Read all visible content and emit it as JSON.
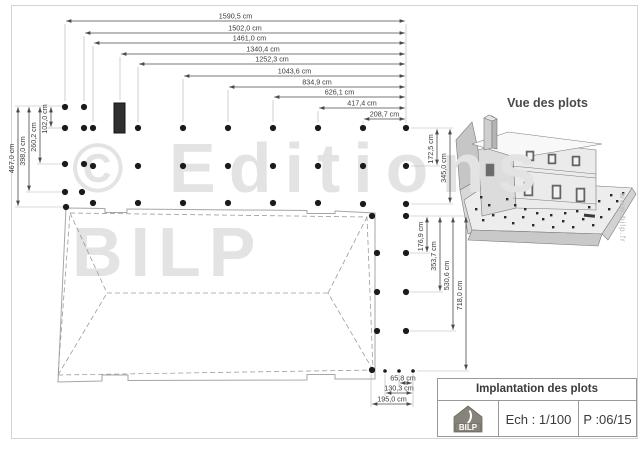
{
  "watermark": {
    "line1": "© Editions",
    "line2": "BILP",
    "color": "#e3e3e3"
  },
  "site_vertical_text": "www.bilp.fr",
  "view3d": {
    "title": "Vue des plots"
  },
  "titleblock": {
    "title": "Implantation des plots",
    "scale_label": "Ech : 1/100",
    "page_label": "P :06/15",
    "logo_text": "BILP"
  },
  "plan": {
    "unit": "cm",
    "top_dims": [
      {
        "label": "1590,5 cm",
        "x1": 65,
        "x2": 406,
        "y": 21
      },
      {
        "label": "1502,0 cm",
        "x1": 84,
        "x2": 406,
        "y": 33
      },
      {
        "label": "1461,0 cm",
        "x1": 93,
        "x2": 406,
        "y": 43
      },
      {
        "label": "1340,4 cm",
        "x1": 120,
        "x2": 406,
        "y": 54
      },
      {
        "label": "1252,3 cm",
        "x1": 138,
        "x2": 406,
        "y": 64
      },
      {
        "label": "1043,6 cm",
        "x1": 183,
        "x2": 406,
        "y": 76
      },
      {
        "label": "834,9 cm",
        "x1": 228,
        "x2": 406,
        "y": 87
      },
      {
        "label": "626,1 cm",
        "x1": 273,
        "x2": 406,
        "y": 97
      },
      {
        "label": "417,4 cm",
        "x1": 318,
        "x2": 406,
        "y": 108
      },
      {
        "label": "208,7 cm",
        "x1": 363,
        "x2": 406,
        "y": 119
      }
    ],
    "left_dims": [
      {
        "label": "467,0 cm",
        "x": 18,
        "y1": 106,
        "y2": 207
      },
      {
        "label": "398,0 cm",
        "x": 29,
        "y1": 106,
        "y2": 192
      },
      {
        "label": "260,2 cm",
        "x": 40,
        "y1": 106,
        "y2": 164
      },
      {
        "label": "102,0 cm",
        "x": 51,
        "y1": 106,
        "y2": 128
      }
    ],
    "right_dims_upper": [
      {
        "label": "172,5 cm",
        "x": 437,
        "y1": 128,
        "y2": 166
      },
      {
        "label": "345,0 cm",
        "x": 450,
        "y1": 128,
        "y2": 204
      }
    ],
    "right_dims_lower": [
      {
        "label": "176,9 cm",
        "x": 427,
        "y1": 216,
        "y2": 253
      },
      {
        "label": "353,7 cm",
        "x": 440,
        "y1": 216,
        "y2": 292
      },
      {
        "label": "530,6 cm",
        "x": 453,
        "y1": 216,
        "y2": 331
      },
      {
        "label": "718,0 cm",
        "x": 466,
        "y1": 216,
        "y2": 371
      }
    ],
    "bottom_dims": [
      {
        "label": "65,8 cm",
        "y": 383,
        "x1": 399,
        "x2": 413,
        "lx": 403
      },
      {
        "label": "130,3 cm",
        "y": 393,
        "x1": 385,
        "x2": 413,
        "lx": 399
      },
      {
        "label": "195,0 cm",
        "y": 404,
        "x1": 371,
        "x2": 413,
        "lx": 392
      }
    ],
    "ext_vertical": [
      [
        65,
        24,
        101
      ],
      [
        84,
        36,
        101
      ],
      [
        93,
        46,
        122
      ],
      [
        120,
        57,
        100
      ],
      [
        138,
        67,
        122
      ],
      [
        183,
        79,
        122
      ],
      [
        228,
        90,
        122
      ],
      [
        273,
        100,
        122
      ],
      [
        318,
        111,
        122
      ],
      [
        363,
        121,
        124
      ],
      [
        406,
        24,
        123
      ],
      [
        371,
        374,
        407
      ],
      [
        385,
        374,
        396
      ],
      [
        399,
        374,
        386
      ],
      [
        413,
        374,
        407
      ]
    ],
    "ext_horizontal": [
      [
        106,
        15,
        62
      ],
      [
        128,
        48,
        62
      ],
      [
        164,
        37,
        62
      ],
      [
        192,
        26,
        62
      ],
      [
        207,
        15,
        63
      ],
      [
        128,
        411,
        453
      ],
      [
        166,
        411,
        440
      ],
      [
        204,
        411,
        453
      ],
      [
        216,
        410,
        469
      ],
      [
        253,
        410,
        430
      ],
      [
        292,
        410,
        443
      ],
      [
        331,
        410,
        456
      ],
      [
        371,
        417,
        469
      ]
    ],
    "dots": [
      [
        65,
        107
      ],
      [
        84,
        107
      ],
      [
        65,
        128
      ],
      [
        84,
        128
      ],
      [
        93,
        128
      ],
      [
        138,
        128
      ],
      [
        183,
        128
      ],
      [
        228,
        128
      ],
      [
        273,
        128
      ],
      [
        318,
        128
      ],
      [
        363,
        128
      ],
      [
        406,
        128
      ],
      [
        65,
        164
      ],
      [
        84,
        164
      ],
      [
        93,
        166
      ],
      [
        138,
        166
      ],
      [
        183,
        166
      ],
      [
        228,
        166
      ],
      [
        273,
        166
      ],
      [
        318,
        166
      ],
      [
        363,
        166
      ],
      [
        406,
        166
      ],
      [
        65,
        192
      ],
      [
        82,
        192
      ],
      [
        66,
        207
      ],
      [
        93,
        203
      ],
      [
        138,
        203
      ],
      [
        183,
        203
      ],
      [
        228,
        203
      ],
      [
        273,
        203
      ],
      [
        318,
        203
      ],
      [
        363,
        204
      ],
      [
        406,
        204
      ],
      [
        372,
        216
      ],
      [
        406,
        216
      ],
      [
        377,
        253
      ],
      [
        406,
        253
      ],
      [
        377,
        292
      ],
      [
        406,
        292
      ],
      [
        377,
        331
      ],
      [
        406,
        331
      ],
      [
        372,
        370
      ]
    ],
    "small_dots": [
      [
        385,
        371
      ],
      [
        399,
        371
      ],
      [
        413,
        371
      ]
    ],
    "chimney": {
      "x": 114,
      "y": 103,
      "w": 11,
      "h": 30
    }
  }
}
